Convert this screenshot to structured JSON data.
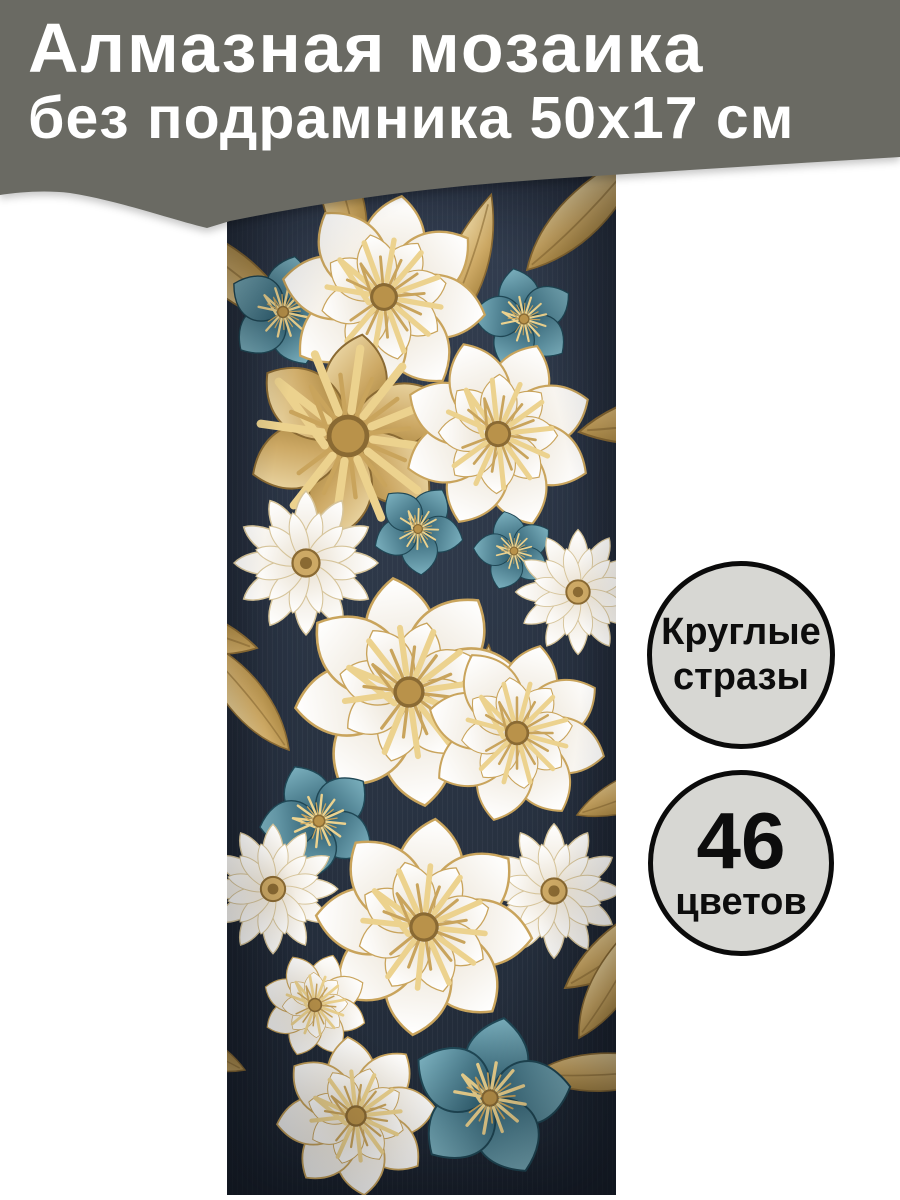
{
  "banner": {
    "title_line1": "Алмазная мозаика",
    "title_line2": "без подрамника 50х17 см"
  },
  "badges": {
    "round_drills": {
      "line1": "Круглые",
      "line2": "стразы"
    },
    "colors_count": {
      "value": "46",
      "label": "цветов"
    }
  },
  "colors": {
    "page_bg": "#FFFFFF",
    "banner_bg": "#6A6A63",
    "banner_text": "#FFFFFF",
    "badge_bg": "#D7D7D3",
    "badge_border": "#0B0B0B",
    "badge_text": "#0D0D0D",
    "art_background": "#27303F",
    "art_gold": "#C9A45C",
    "art_teal": "#41768A",
    "art_white": "#F4EFE4"
  }
}
